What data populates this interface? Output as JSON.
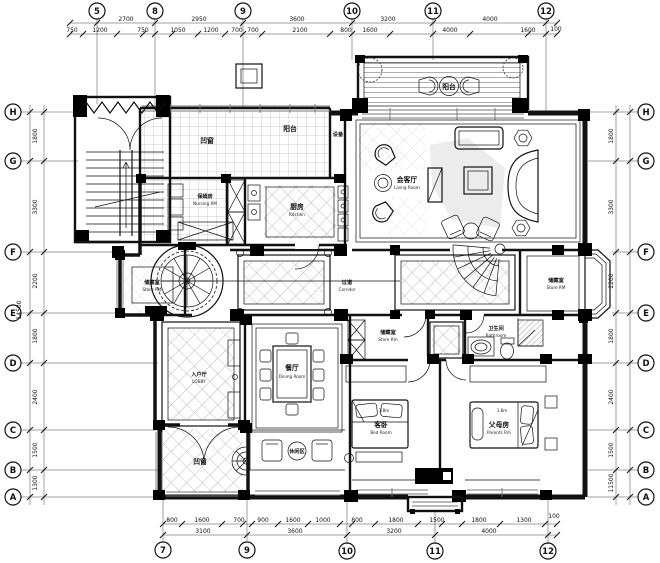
{
  "page": {
    "bg": "#ffffff",
    "line_color": "#111111"
  },
  "grid": {
    "top": [
      "5",
      "8",
      "9",
      "10",
      "11",
      "12"
    ],
    "bottom": [
      "7",
      "9",
      "10",
      "11",
      "12"
    ],
    "left": [
      "H",
      "G",
      "F",
      "E",
      "D",
      "C",
      "B",
      "A"
    ],
    "right": [
      "H",
      "G",
      "F",
      "E",
      "D",
      "C",
      "B",
      "A"
    ]
  },
  "dims": {
    "top_major": [
      "2700",
      "2950",
      "3600",
      "3200",
      "4000"
    ],
    "top_minor": [
      "750",
      "1200",
      "750",
      "1050",
      "1200",
      "700",
      "700",
      "2100",
      "800",
      "1600",
      "4000",
      "1600",
      "100"
    ],
    "bottom_major": [
      "3100",
      "3600",
      "3200",
      "4000"
    ],
    "bottom_minor": [
      "800",
      "1600",
      "700",
      "900",
      "1600",
      "1000",
      "800",
      "1800",
      "1500",
      "1800",
      "1300",
      "100"
    ],
    "left_v": [
      "1800",
      "3300",
      "2200",
      "1800",
      "2400",
      "1500",
      "1300"
    ],
    "right_v": [
      "1800",
      "3300",
      "2200",
      "1800",
      "2400",
      "1500",
      "1300"
    ],
    "left_total": "14500",
    "right_total": "11500"
  },
  "rooms": {
    "bay_top": {
      "zh": "凹窗"
    },
    "balcony_small": {
      "zh": "阳台"
    },
    "equipment": {
      "zh": "设备"
    },
    "nanny": {
      "zh": "保姆房",
      "en": "Nursing RM"
    },
    "kitchen": {
      "zh": "厨房",
      "en": "Kitchen"
    },
    "balcony_main": {
      "zh": "阳台"
    },
    "living": {
      "zh": "会客厅",
      "en": "Living Room"
    },
    "corridor": {
      "zh": "过道",
      "en": "Corridor"
    },
    "store_left": {
      "zh": "储藏室",
      "en": "Store RM"
    },
    "store_right": {
      "zh": "储藏室",
      "en": "Store RM"
    },
    "store_mid": {
      "zh": "储藏室",
      "en": "Store Rm"
    },
    "bath": {
      "zh": "卫生间",
      "en": "Bathroom"
    },
    "lobby": {
      "zh": "入户厅",
      "en": "LOBBY"
    },
    "dining": {
      "zh": "餐厅",
      "en": "Dining Room"
    },
    "leisure": {
      "zh": "休闲区"
    },
    "bay_bottom": {
      "zh": "凹窗"
    },
    "guest": {
      "zh": "客卧",
      "en": "Bed Room",
      "bed": "1.8m"
    },
    "parents": {
      "zh": "父母房",
      "en": "Parents Rm",
      "bed": "1.8m"
    }
  }
}
